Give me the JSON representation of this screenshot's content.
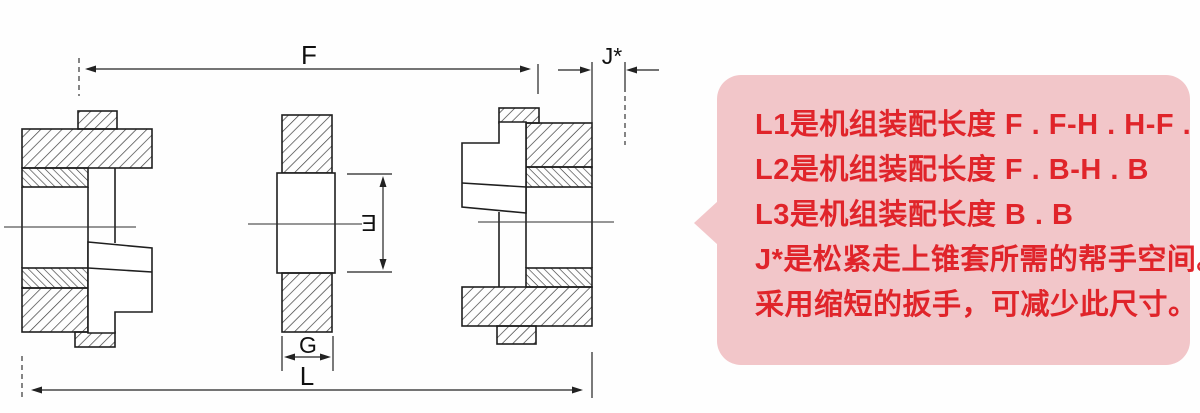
{
  "drawing": {
    "dimension_labels": {
      "F": "F",
      "J": "J*",
      "E": "E",
      "G": "G",
      "L": "L"
    },
    "line_color": "#1f1f1f"
  },
  "callout": {
    "lines": [
      "L1是机组装配长度 F . F-H . H-F . H",
      "L2是机组装配长度 F . B-H . B",
      "L3是机组装配长度 B . B",
      "J*是松紧走上锥套所需的帮手空间。",
      "采用缩短的扳手，可减少此尺寸。"
    ],
    "colors": {
      "background": "#f2c6c9",
      "text": "#e0242a"
    }
  }
}
